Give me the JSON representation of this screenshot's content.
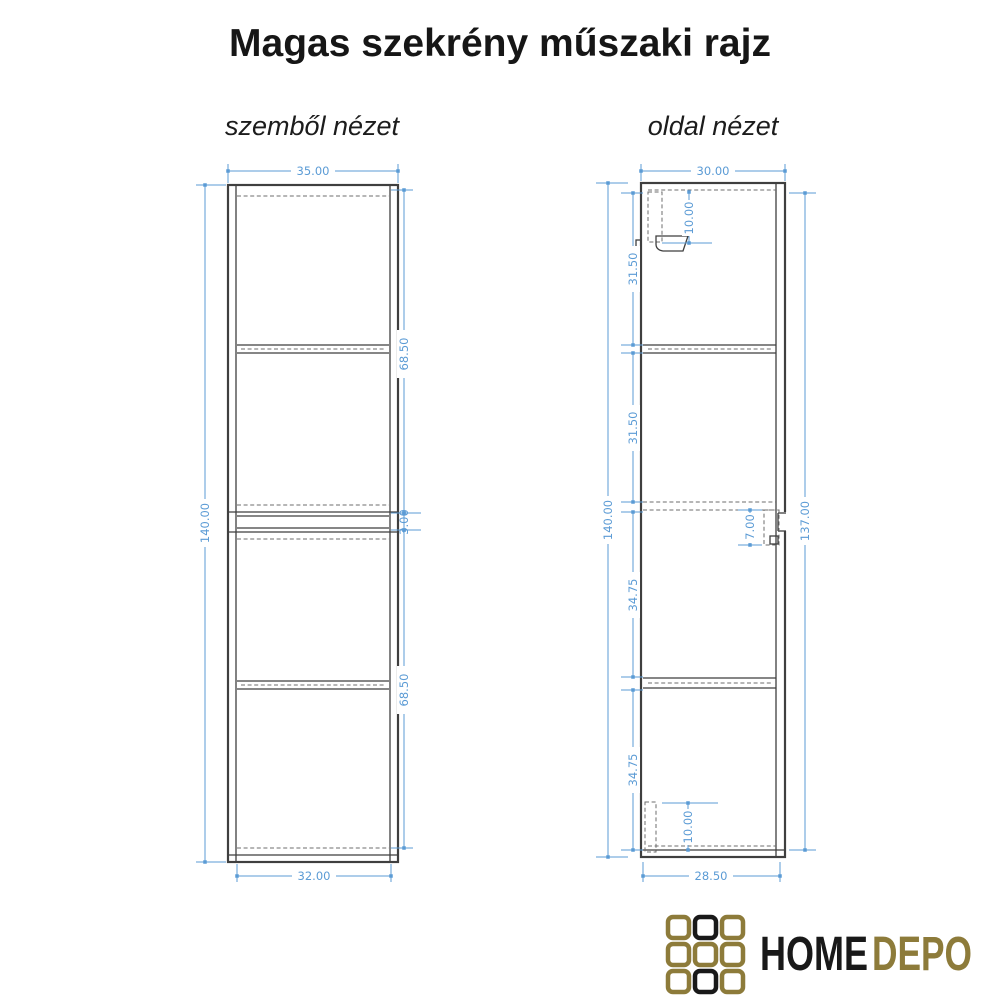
{
  "title": "Magas szekrény műszaki rajz",
  "front_view": {
    "label": "szemből nézet",
    "width_top": "35.00",
    "height_left": "140.00",
    "door_upper": "68.50",
    "gap_middle": "3.00",
    "door_lower": "68.50",
    "width_bottom": "32.00"
  },
  "side_view": {
    "label": "oldal nézet",
    "depth_top": "30.00",
    "height_left": "140.00",
    "sections": [
      "31.50",
      "31.50",
      "34.75",
      "34.75"
    ],
    "height_right": "137.00",
    "depth_bottom": "28.50",
    "bracket_top": "10.00",
    "detail_middle": "7.00",
    "bracket_bottom": "10.00"
  },
  "logo": {
    "word_primary": "HOME",
    "word_secondary": "DEPO"
  },
  "colors": {
    "dimension_blue": "#5b9bd5",
    "drawing_line": "#3f3f3f",
    "hidden_line_gray": "#6e6e6e",
    "logo_gold": "#8d7b3a",
    "logo_black": "#191919",
    "background": "#ffffff"
  }
}
